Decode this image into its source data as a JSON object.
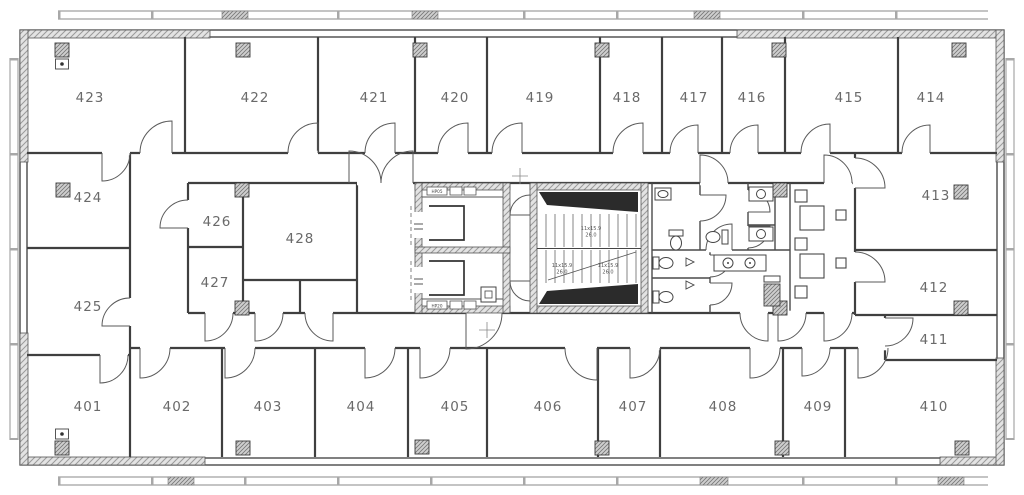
{
  "colors": {
    "wall": "#3f3f3f",
    "hatch_fill": "#e3e3e3",
    "hatch_line": "#9a9a9a",
    "column_fill": "#cfcfcf",
    "label_text": "#6a6a6a",
    "stair_dark": "#2b2b2b",
    "background": "#ffffff"
  },
  "rooms": {
    "top": [
      "423",
      "422",
      "421",
      "420",
      "419",
      "418",
      "417",
      "416",
      "415",
      "414"
    ],
    "left": [
      "424",
      "425"
    ],
    "core": [
      "426",
      "427",
      "428"
    ],
    "right": [
      "413",
      "412",
      "411"
    ],
    "bottom": [
      "401",
      "402",
      "403",
      "404",
      "405",
      "406",
      "407",
      "408",
      "409",
      "410"
    ]
  },
  "stairs": {
    "labels": [
      {
        "dims": "11x15.9",
        "area": "26.0"
      },
      {
        "dims": "11x15.9",
        "area": "26.0"
      },
      {
        "dims": "11x15.9",
        "area": "26.0"
      }
    ]
  },
  "equipment": {
    "top": "HP05",
    "bottom": "HP20"
  }
}
